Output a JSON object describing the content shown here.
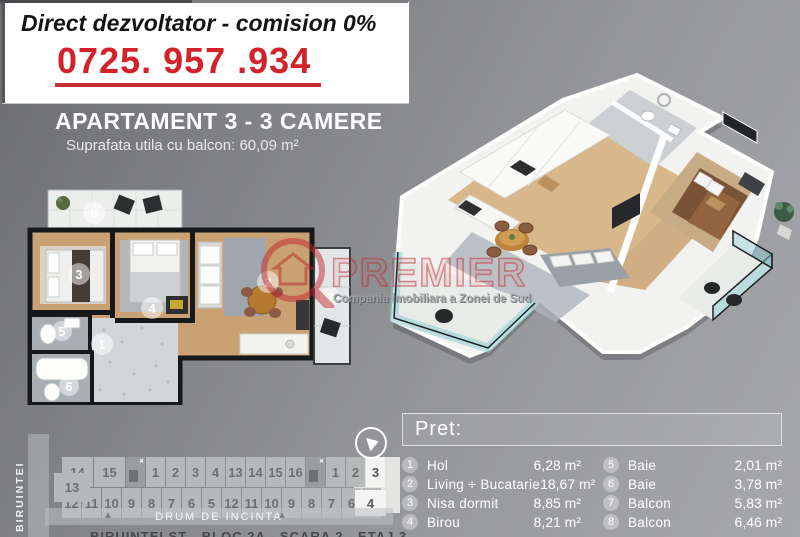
{
  "header": {
    "tagline": "Direct dezvoltator - comision 0%",
    "phone": "0725. 957 .934",
    "title": "APARTAMENT 3 - 3 CAMERE",
    "subtitle": "Suprafata utila cu balcon: 60,09 m²",
    "accent_red": "#d2232a"
  },
  "watermark": {
    "brand": "PREMIER",
    "subtitle": "Compania imobiliara a Zonei de Sud",
    "logo": "magnifier-house-q-icon",
    "accent_color": "#c2252b"
  },
  "plan_2d": {
    "markers": [
      "1",
      "2",
      "3",
      "4",
      "5",
      "6",
      "7",
      "8"
    ]
  },
  "price_panel": {
    "title": "Pret:",
    "left": [
      {
        "num": "1",
        "label": "Hol",
        "area": "6,28 m²"
      },
      {
        "num": "2",
        "label": "Living + Bucatarie",
        "area": "18,67 m²"
      },
      {
        "num": "3",
        "label": "Nisa dormit",
        "area": "8,85 m²"
      },
      {
        "num": "4",
        "label": "Birou",
        "area": "8,21 m²"
      }
    ],
    "right": [
      {
        "num": "5",
        "label": "Baie",
        "area": "2,01 m²"
      },
      {
        "num": "6",
        "label": "Baie",
        "area": "3,78 m²"
      },
      {
        "num": "7",
        "label": "Balcon",
        "area": "5,83 m²"
      },
      {
        "num": "8",
        "label": "Balcon",
        "area": "6,46 m²"
      }
    ]
  },
  "site_plan": {
    "street_left": "BIRUINTEI",
    "road_label": "DRUM DE INCINTA",
    "top_row": [
      {
        "label": "14",
        "type": "wide"
      },
      {
        "label": "15",
        "type": "wide"
      },
      {
        "label": "",
        "type": "stairs"
      },
      {
        "label": "1"
      },
      {
        "label": "2"
      },
      {
        "label": "3"
      },
      {
        "label": "4"
      },
      {
        "label": "13"
      },
      {
        "label": "14"
      },
      {
        "label": "15"
      },
      {
        "label": "16"
      },
      {
        "label": "",
        "type": "stairs"
      },
      {
        "label": "1"
      },
      {
        "label": "2"
      },
      {
        "label": "3",
        "type": "hl"
      }
    ],
    "bottom_row": [
      {
        "label": "12"
      },
      {
        "label": "11"
      },
      {
        "label": "10"
      },
      {
        "label": "9"
      },
      {
        "label": "8"
      },
      {
        "label": "7"
      },
      {
        "label": "6"
      },
      {
        "label": "5"
      },
      {
        "label": "12"
      },
      {
        "label": "11"
      },
      {
        "label": "10"
      },
      {
        "label": "9"
      },
      {
        "label": "8"
      },
      {
        "label": "7"
      },
      {
        "label": "6"
      },
      {
        "label": "5"
      }
    ],
    "offset_left_unit": "13",
    "offset_right_unit": "4",
    "partial_caption_clipped": "BIRUINTEI ST - BLOC 2A - SCARA 2 - ETAJ 3"
  }
}
